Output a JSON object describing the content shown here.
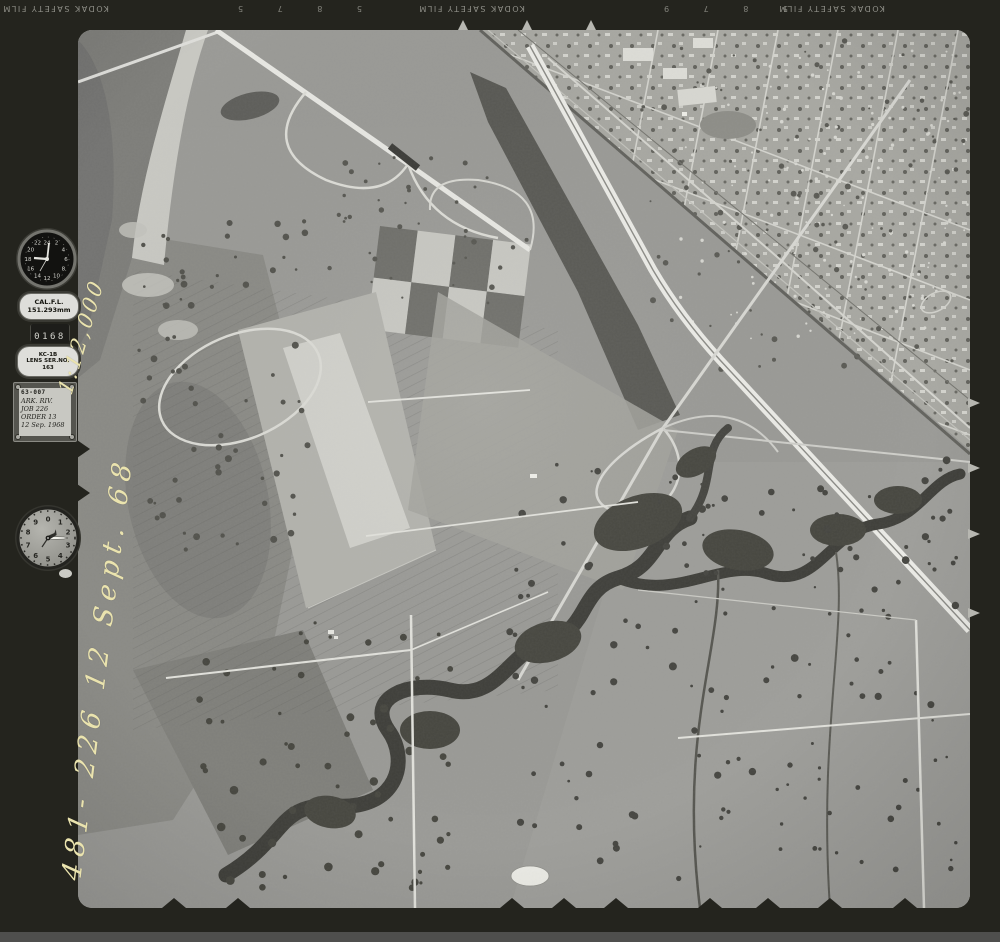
{
  "film": {
    "edge_text": "KODAK SAFETY FILM",
    "edge_numbers_left": "5 8 7 5",
    "edge_numbers_right": "5 8 7 9"
  },
  "instruments": {
    "frame_counter": "0168",
    "clock_numerals": [
      "24",
      "2",
      "4",
      "6",
      "8",
      "10",
      "12",
      "14",
      "16",
      "18",
      "20",
      "22"
    ],
    "altimeter_numerals": [
      "0",
      "1",
      "2",
      "3",
      "4",
      "5",
      "6",
      "7",
      "8",
      "9"
    ]
  },
  "labels": {
    "cal_title": "CAL.F.L.",
    "cal_value": "151.293mm",
    "lens_model": "KC-1B",
    "lens_serial_label": "LENS SER.NO.",
    "lens_serial": "163",
    "plate_code": "63-007",
    "plate_area": "ARK. RIV.",
    "plate_job": "JOB 226",
    "plate_order": "ORDER 13",
    "plate_date": "12 Sep. 1968"
  },
  "annotations": {
    "scale": "1:12,000",
    "frame_id": "481- 226  12 Sept. 68"
  },
  "colors": {
    "film_margin": "#24241e",
    "photo_base": "#9a9a96",
    "handwriting_ink": "#eae3ae"
  }
}
